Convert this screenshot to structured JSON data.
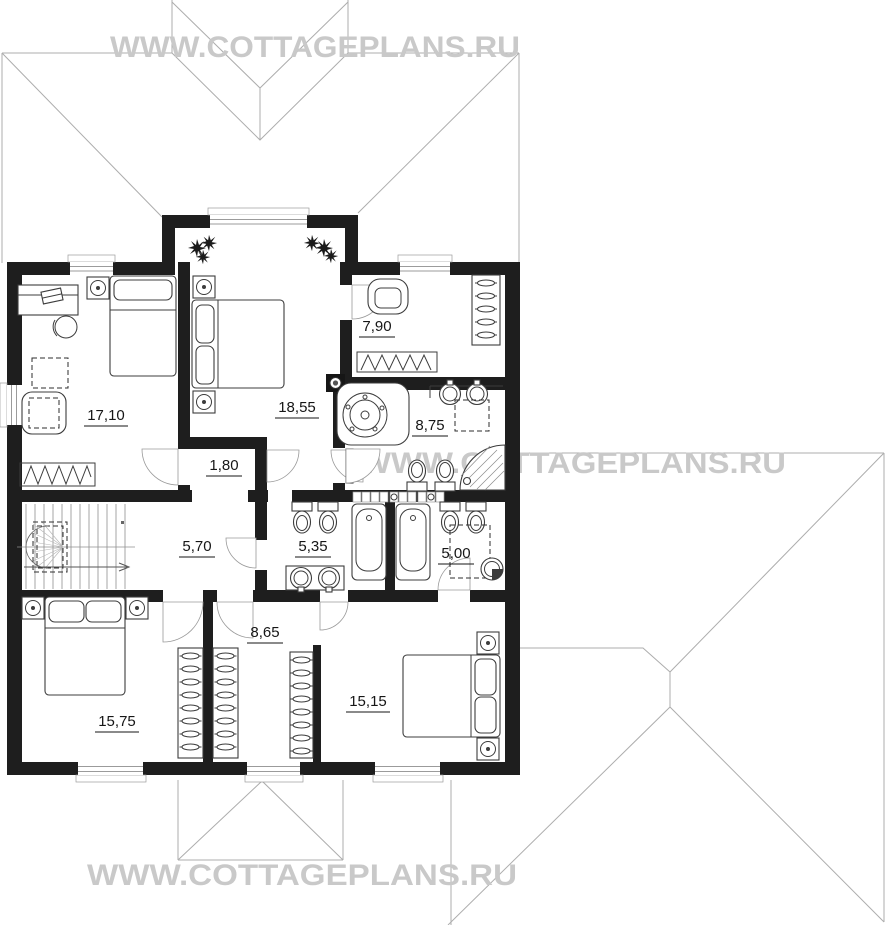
{
  "watermark": {
    "text": "WWW.COTTAGEPLANS.RU",
    "color": "#c9c9c9"
  },
  "rooms": [
    {
      "name": "bedroom-study",
      "area": "17,10"
    },
    {
      "name": "master-bedroom",
      "area": "18,55"
    },
    {
      "name": "dressing-room",
      "area": "7,90"
    },
    {
      "name": "bathroom-master",
      "area": "8,75"
    },
    {
      "name": "corridor",
      "area": "1,80"
    },
    {
      "name": "stair-hall",
      "area": "5,70"
    },
    {
      "name": "bathroom-middle",
      "area": "5,35"
    },
    {
      "name": "shower-room",
      "area": "5,00"
    },
    {
      "name": "wardrobe-hallway",
      "area": "8,65"
    },
    {
      "name": "bedroom-left",
      "area": "15,75"
    },
    {
      "name": "bedroom-right",
      "area": "15,15"
    }
  ],
  "colors": {
    "wall": "#1e1e1e",
    "roof_line": "#adadad",
    "label": "#161616"
  }
}
